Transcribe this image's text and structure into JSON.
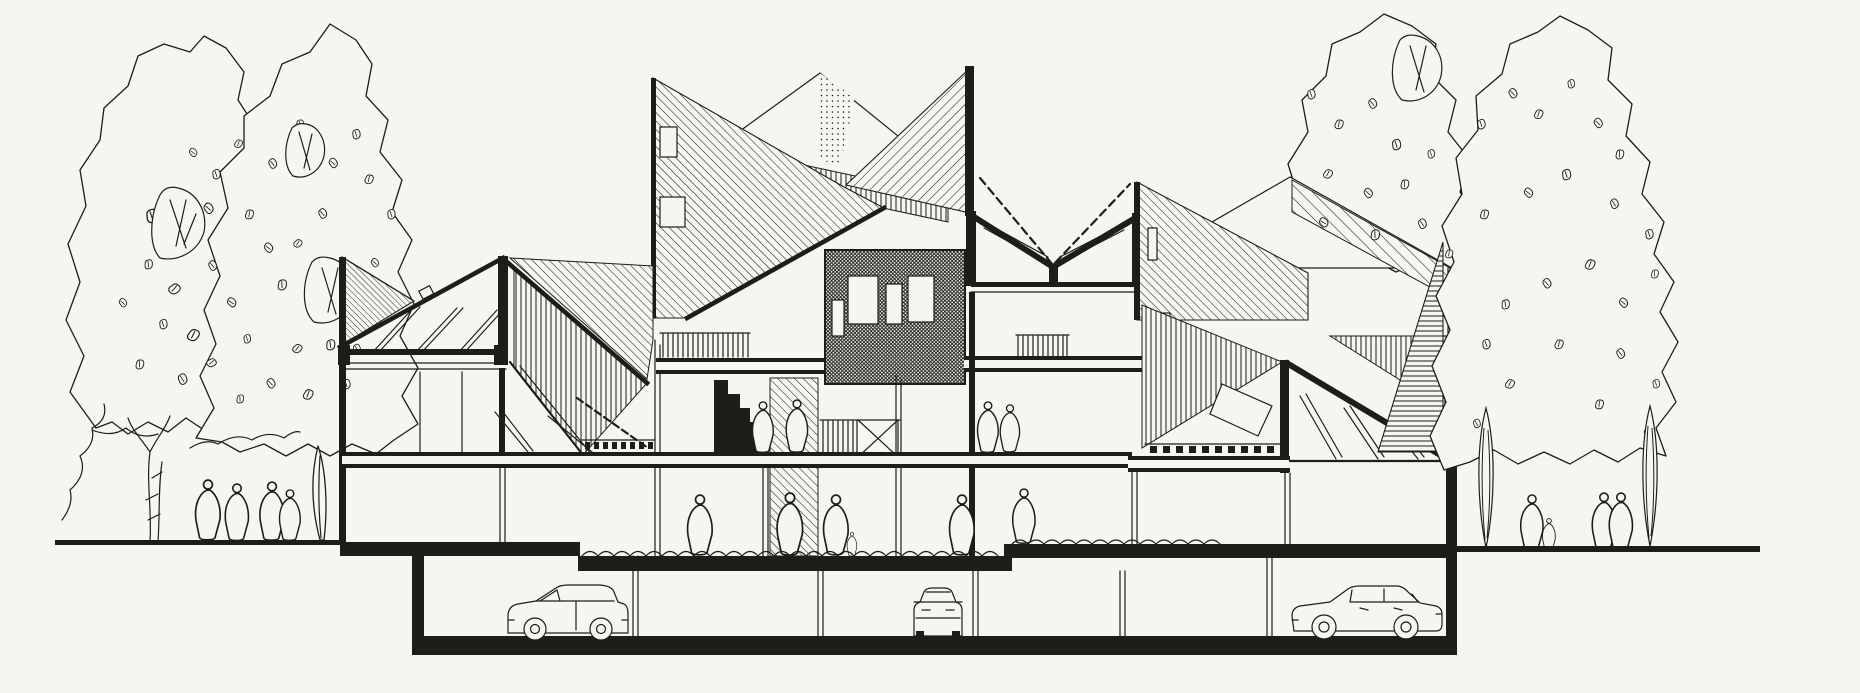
{
  "artwork": {
    "kind": "architectural-section-drawing",
    "technique": "hand-drawn ink line drawing on paper",
    "subject": "cross-section of a terraced housing complex with folded gable and butterfly roofs, central glazed clerestory core, two-storey atrium, open ground floor on posts and an underground parking level",
    "context": "large sketched trees flank both sides, small human figures stand at grade and inside, three cars occupy the basement garage"
  },
  "colors": {
    "paper": "#f6f5f0",
    "ink": "#1f1d1a"
  },
  "inventory": {
    "trees": {
      "left_canopies": 2,
      "right_canopies": 2,
      "slender_trees_right": 2,
      "sapling_left": 1
    },
    "people": {
      "outdoor_left": 4,
      "outdoor_right": 4,
      "indoor_upper": 4,
      "indoor_courtyard": 5,
      "on_stair_silhouette": 1
    },
    "cars": [
      {
        "type": "van-side-view",
        "location": "left basement bay"
      },
      {
        "type": "car-rear-view",
        "location": "centre basement bay"
      },
      {
        "type": "sedan-side-view",
        "location": "right basement bay"
      }
    ],
    "roof_forms": [
      "mono-pitch",
      "crossed twin gables",
      "white peak",
      "butterfly",
      "mono-pitch wing"
    ],
    "hatch_directions": [
      "backslash",
      "forwardslash",
      "vertical",
      "horizontal",
      "dense-grid",
      "stipple"
    ],
    "levels": [
      "underground parking",
      "open ground floor",
      "upper floor with balconies",
      "roofscape"
    ]
  }
}
